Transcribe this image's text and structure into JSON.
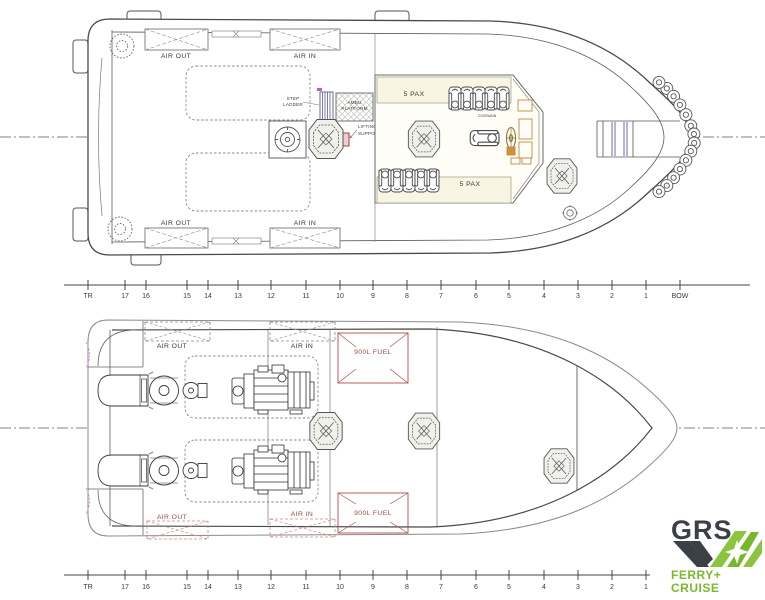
{
  "top_view": {
    "vent_top_out": "AIR OUT",
    "vent_top_in": "AIR IN",
    "vent_bottom_out": "AIR OUT",
    "vent_bottom_in": "AIR IN",
    "step_ladder_line1": "STEP",
    "step_ladder_line2": "LADDER",
    "platform_line1": "AMBU",
    "platform_line2": "PLATFORM",
    "lifting_line1": "LIFTING HOOK",
    "lifting_line2": "SUPPORT PILLAR",
    "pax_port": "5 PAX",
    "pax_starboard": "5 PAX",
    "coxswain": "COXSWAIN"
  },
  "lower_view": {
    "vent_top_out": "AIR OUT",
    "vent_top_in": "AIR IN",
    "vent_bottom_out": "AIR OUT",
    "vent_bottom_in": "AIR IN",
    "fuel_tank_port": "900L FUEL",
    "fuel_tank_starboard": "900L FUEL"
  },
  "ruler": {
    "labels": [
      "TR",
      "17",
      "16",
      "15",
      "14",
      "13",
      "12",
      "11",
      "10",
      "9",
      "8",
      "7",
      "6",
      "5",
      "4",
      "3",
      "2",
      "1",
      "BOW"
    ]
  },
  "logo": {
    "brand": "GRS",
    "tagline_line1": "FERRY+",
    "tagline_line2": "CRUISE"
  },
  "colors": {
    "line": "#444444",
    "dashed": "#888888",
    "red": "#b34d4d",
    "red_text": "#9a4f42",
    "green": "#7cb82f",
    "logo_dark": "#3b4046",
    "blue": "#6b6bb8",
    "magenta": "#cc55cc",
    "tan": "#c08a40",
    "cream": "#f8f5e2"
  }
}
